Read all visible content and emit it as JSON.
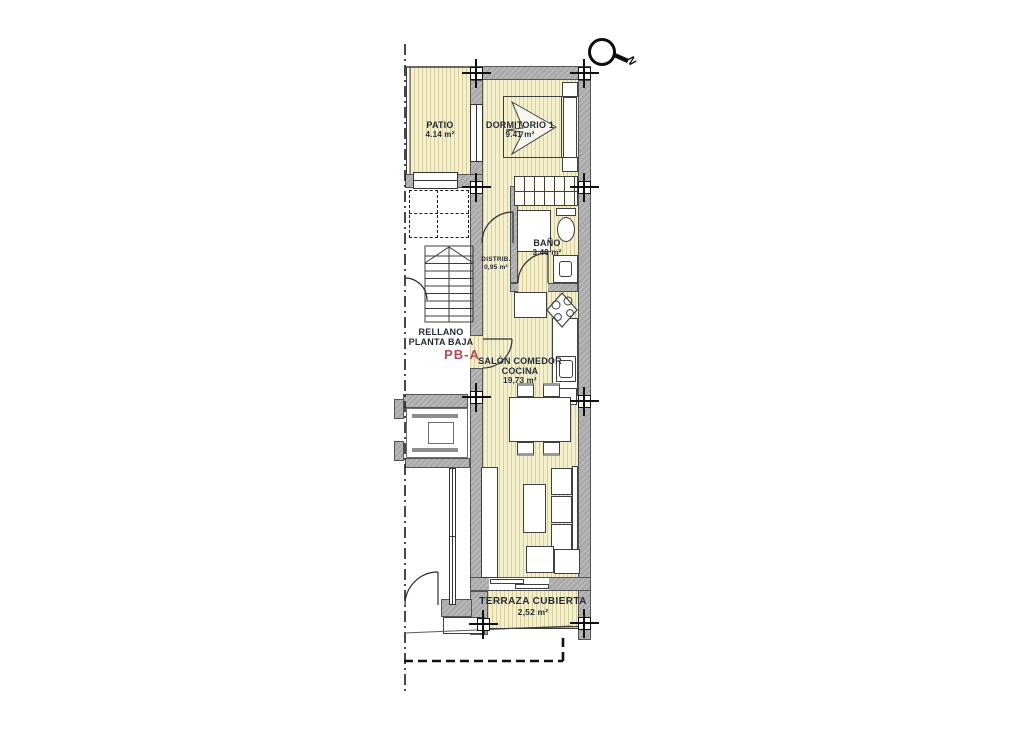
{
  "plan": {
    "north_label": "N",
    "unit_code": "PB-A",
    "landing": {
      "line1": "RELLANO",
      "line2": "PLANTA BAJA"
    },
    "rooms": {
      "patio": {
        "name": "PATIO",
        "area": "4.14 m²"
      },
      "dormitorio": {
        "name": "DORMITORIO 1",
        "area": "9.41 m²"
      },
      "bano": {
        "name": "BAÑO",
        "area": "3.40 m²"
      },
      "distrib": {
        "name": "DISTRIB.",
        "area": "0,95 m²"
      },
      "salon": {
        "name1": "SALÓN COMEDOR",
        "name2": "COCINA",
        "area": "19,73 m²"
      },
      "terraza": {
        "name": "TERRAZA CUBIERTA",
        "area": "2,52 m²"
      }
    },
    "colors": {
      "room_fill": "#f5f0cc",
      "wall_fill": "#a9a9a9",
      "accent": "#b34a5a",
      "ink": "#262a36"
    }
  }
}
